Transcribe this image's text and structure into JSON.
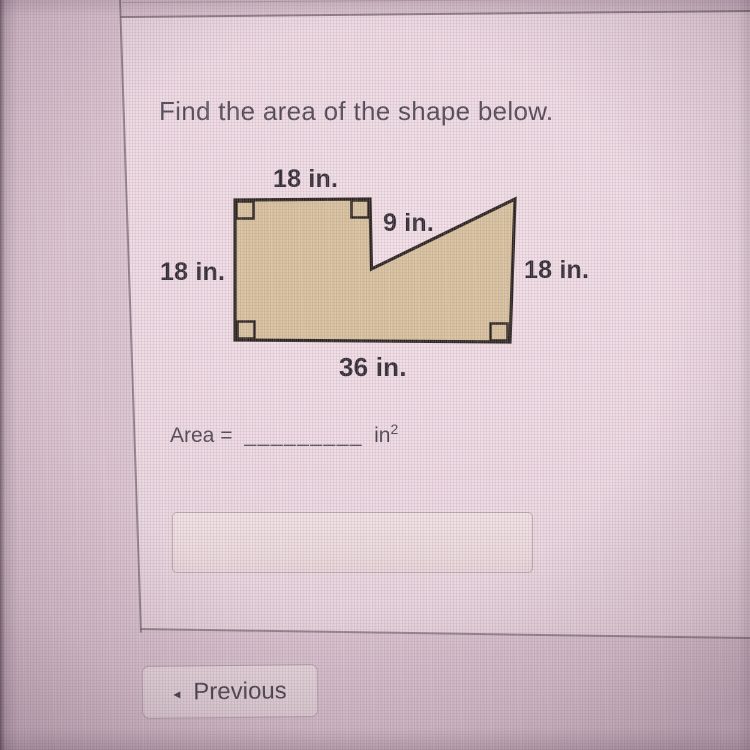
{
  "page": {
    "background_color": "#d7c1cd",
    "panel_color": "#ecd9e1"
  },
  "question": {
    "title": "Find the area of the shape below.",
    "area_label": "Area =",
    "blank": "_________",
    "unit": "in",
    "unit_sup": "2",
    "answer_value": ""
  },
  "figure": {
    "fill": "#d6c19c",
    "stroke": "#29231f",
    "labels": {
      "top": "18 in.",
      "notch": "9 in.",
      "left": "18 in.",
      "right": "18 in.",
      "bottom": "36 in."
    }
  },
  "nav": {
    "previous": "Previous",
    "previous_icon": "◂"
  }
}
